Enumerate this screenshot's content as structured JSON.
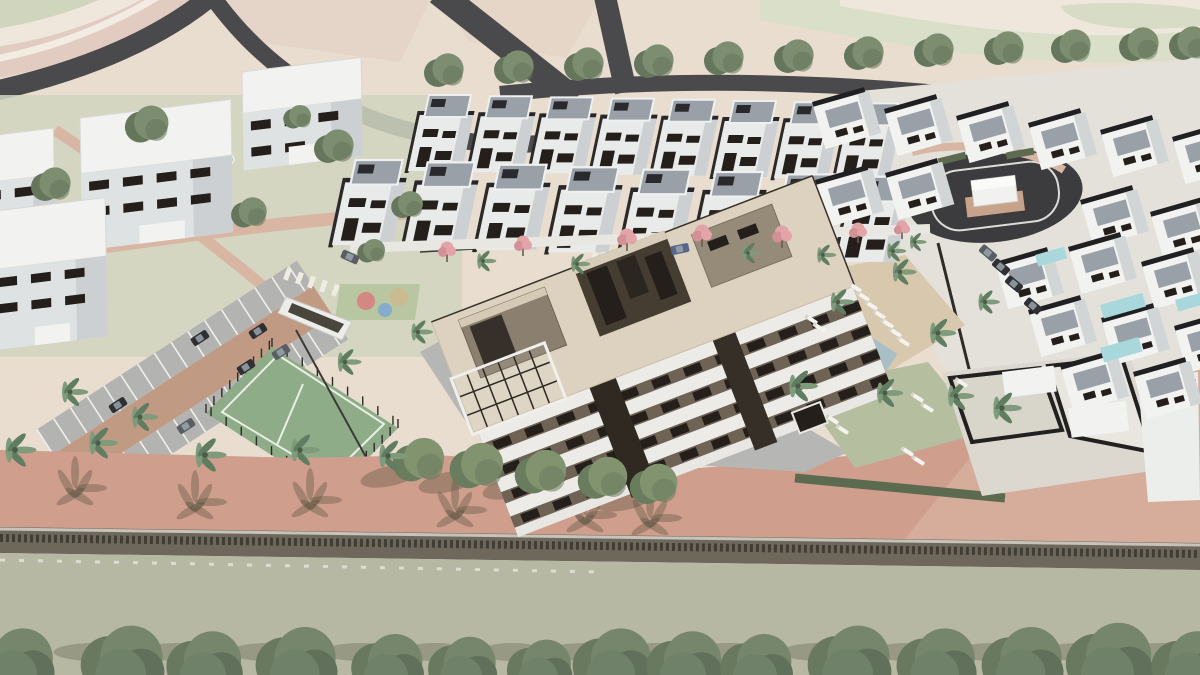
{
  "scene": {
    "type": "3d-architectural-render",
    "subject": "aerial-residential-development-render",
    "canvas": {
      "width": 1200,
      "height": 675
    }
  },
  "palette": {
    "sand": "#e8ddcf",
    "sand2": "#e3d5c5",
    "band_pink": "#e2ccc2",
    "band_cream": "#efe7db",
    "band_green": "#cfd6bd",
    "band_green2": "#d9dfc9",
    "road": "#4a4a4c",
    "road_dark": "#3c3c3e",
    "grass": "#d0d5bf",
    "lawn": "#b5bfa0",
    "court": "#8fac88",
    "court_line": "#e9efe4",
    "pool": "#a7bfc5",
    "pool_light": "#c6d8da",
    "villa_pool": "#a8d8dc",
    "white_hi": "#f2f3f1",
    "white": "#e9ebea",
    "white_shade": "#ccd0d3",
    "roof_gray": "#9aa0a7",
    "dark": "#2c2a28",
    "window": "#241f1b",
    "bld_cream": "#dcd2bf",
    "bld_taupe": "#8b8070",
    "bld_taupe_dark": "#463d32",
    "bld_recess": "#6e6355",
    "tree_green": "#7d8d6f",
    "tree_dark": "#66765c",
    "palm_green": "#7f9b7c",
    "palm_dark": "#5f7d61",
    "pink_tree": "#e2a4a8",
    "pink_tree2": "#d19197",
    "car_dark": "#2e3033",
    "car_gray": "#595e63",
    "car_blue": "#56688a",
    "hedge": "#5c6a50",
    "wall_base": "#6e685c",
    "wall_dark": "#403d35",
    "wall_top": "#c6c3bb",
    "field": "#b7b8a4",
    "stall": "#b3b3b1",
    "aisle": "#c09a83",
    "promenade": "#cf9e8d",
    "promenade_light": "#d9b2a1",
    "sidewalk_pink": "#d9b5a4",
    "deck_tan": "#d8c8ae",
    "plaza": "#b6b6b4",
    "right_paving": "#e4e1db",
    "shadow": "rgba(85,80,60,0.36)"
  },
  "bottom_trees": {
    "baseline_y": 690,
    "items": [
      [
        15,
        44
      ],
      [
        123,
        46
      ],
      [
        205,
        42
      ],
      [
        297,
        45
      ],
      [
        388,
        40
      ],
      [
        463,
        38
      ],
      [
        540,
        36
      ],
      [
        613,
        44
      ],
      [
        685,
        42
      ],
      [
        757,
        40
      ],
      [
        850,
        46
      ],
      [
        937,
        44
      ],
      [
        1023,
        45
      ],
      [
        1110,
        48
      ],
      [
        1190,
        42
      ]
    ]
  },
  "promenade_trees": [
    [
      420,
      462,
      26
    ],
    [
      478,
      468,
      27
    ],
    [
      542,
      474,
      26
    ],
    [
      604,
      480,
      25
    ],
    [
      655,
      486,
      24
    ]
  ],
  "street_trees_top": [
    [
      445,
      72
    ],
    [
      515,
      69
    ],
    [
      585,
      66
    ],
    [
      655,
      63
    ],
    [
      725,
      60
    ],
    [
      795,
      58
    ],
    [
      865,
      55
    ],
    [
      935,
      52
    ],
    [
      1005,
      50
    ],
    [
      1072,
      48
    ],
    [
      1140,
      46
    ],
    [
      1190,
      45
    ]
  ],
  "left_trees": [
    [
      52,
      186,
      20
    ],
    [
      148,
      126,
      22
    ],
    [
      250,
      214,
      18
    ],
    [
      335,
      148,
      20
    ],
    [
      408,
      206,
      16
    ],
    [
      372,
      252,
      14
    ],
    [
      298,
      118,
      14
    ]
  ],
  "pink_trees": [
    [
      447,
      252,
      1
    ],
    [
      523,
      246,
      1
    ],
    [
      627,
      240,
      1.1
    ],
    [
      702,
      236,
      1.1
    ],
    [
      782,
      237,
      1.1
    ],
    [
      858,
      233,
      1
    ],
    [
      902,
      230,
      0.9
    ]
  ],
  "palms": [
    [
      15,
      450,
      1.3
    ],
    [
      70,
      392,
      1.1
    ],
    [
      98,
      443,
      1.2
    ],
    [
      140,
      417,
      1.1
    ],
    [
      205,
      455,
      1.3
    ],
    [
      300,
      450,
      1.2
    ],
    [
      345,
      362,
      1.0
    ],
    [
      388,
      456,
      1.2
    ],
    [
      418,
      332,
      0.9
    ],
    [
      798,
      386,
      1.2
    ],
    [
      838,
      302,
      1.0
    ],
    [
      900,
      272,
      1.0
    ],
    [
      938,
      333,
      1.1
    ],
    [
      885,
      393,
      1.1
    ],
    [
      956,
      396,
      1.1
    ],
    [
      985,
      302,
      0.9
    ],
    [
      483,
      261,
      0.8
    ],
    [
      577,
      264,
      0.8
    ],
    [
      748,
      253,
      0.8
    ],
    [
      823,
      255,
      0.8
    ],
    [
      893,
      251,
      0.8
    ],
    [
      915,
      242,
      0.7
    ],
    [
      1002,
      408,
      1.2
    ]
  ],
  "cars": [
    [
      200,
      338,
      -33,
      "car_dark"
    ],
    [
      258,
      331,
      -33,
      "car_dark"
    ],
    [
      281,
      352,
      -33,
      "car_gray"
    ],
    [
      246,
      367,
      -33,
      "car_dark"
    ],
    [
      118,
      405,
      -33,
      "car_dark"
    ],
    [
      186,
      426,
      -33,
      "car_gray"
    ],
    [
      350,
      257,
      24,
      "car_gray"
    ],
    [
      680,
      249,
      -12,
      "car_blue"
    ],
    [
      988,
      253,
      40,
      "car_gray"
    ],
    [
      1001,
      267,
      40,
      "car_dark"
    ],
    [
      1014,
      284,
      40,
      "car_dark"
    ],
    [
      1033,
      306,
      40,
      "car_dark"
    ]
  ],
  "loungers": [
    [
      856,
      288,
      33
    ],
    [
      864,
      297,
      33
    ],
    [
      872,
      306,
      33
    ],
    [
      880,
      315,
      33
    ],
    [
      888,
      324,
      33
    ],
    [
      896,
      333,
      33
    ],
    [
      904,
      342,
      33
    ],
    [
      812,
      320,
      33
    ],
    [
      820,
      328,
      33
    ],
    [
      833,
      420,
      33
    ],
    [
      843,
      430,
      33
    ],
    [
      918,
      398,
      33
    ],
    [
      928,
      408,
      33
    ],
    [
      908,
      452,
      33
    ],
    [
      919,
      461,
      33
    ],
    [
      962,
      383,
      33
    ]
  ],
  "apartment_blocks": [
    [
      -28,
      138,
      82,
      110
    ],
    [
      80,
      118,
      152,
      132
    ],
    [
      242,
      72,
      120,
      98
    ],
    [
      -12,
      212,
      118,
      138
    ]
  ],
  "townhouse_rows": {
    "back": {
      "x0": 424,
      "y0": 95,
      "dx": 61,
      "dy": 1.2,
      "count": 8,
      "scale": 1.0
    },
    "front": {
      "x0": 350,
      "y0": 160,
      "dx": 72,
      "dy": 2.4,
      "count": 8,
      "scale": 1.12
    }
  },
  "villas_upper": [
    [
      812,
      102
    ],
    [
      884,
      109
    ],
    [
      956,
      116
    ],
    [
      1028,
      123
    ],
    [
      1100,
      130
    ],
    [
      1172,
      137
    ],
    [
      815,
      180
    ],
    [
      885,
      173
    ],
    [
      1080,
      200
    ],
    [
      1150,
      212
    ]
  ],
  "villas_lower": [
    [
      995,
      262
    ],
    [
      1068,
      247
    ],
    [
      1141,
      262
    ],
    [
      1028,
      310
    ],
    [
      1101,
      318
    ],
    [
      1174,
      326
    ],
    [
      1060,
      365
    ],
    [
      1133,
      372
    ]
  ],
  "villa_pools": [
    [
      1100,
      305,
      44,
      14
    ],
    [
      1175,
      300,
      30,
      12
    ],
    [
      1100,
      348,
      40,
      15
    ],
    [
      1035,
      255,
      30,
      12
    ]
  ],
  "playground": {
    "pad": [
      340,
      284,
      80,
      36
    ],
    "circles": [
      [
        366,
        301,
        9,
        "#d77f7f"
      ],
      [
        385,
        310,
        7,
        "#7fa8d0"
      ],
      [
        399,
        297,
        9,
        "#cdb98e"
      ]
    ]
  },
  "roundabout": {
    "cx": 995,
    "cy": 196,
    "rx": 88,
    "ry": 46,
    "rot": -7,
    "utility_box": {
      "w": 44,
      "h": 26
    }
  },
  "main_pool": {
    "x": 793,
    "y": 298,
    "rot": 33,
    "w": 118,
    "h": 52
  },
  "tennis_court": {
    "points": [
      [
        272,
        347
      ],
      [
        398,
        428
      ],
      [
        332,
        494
      ],
      [
        206,
        413
      ]
    ]
  },
  "small_pool": {
    "cx": 220,
    "cy": 161,
    "rx": 14,
    "ry": 7
  }
}
